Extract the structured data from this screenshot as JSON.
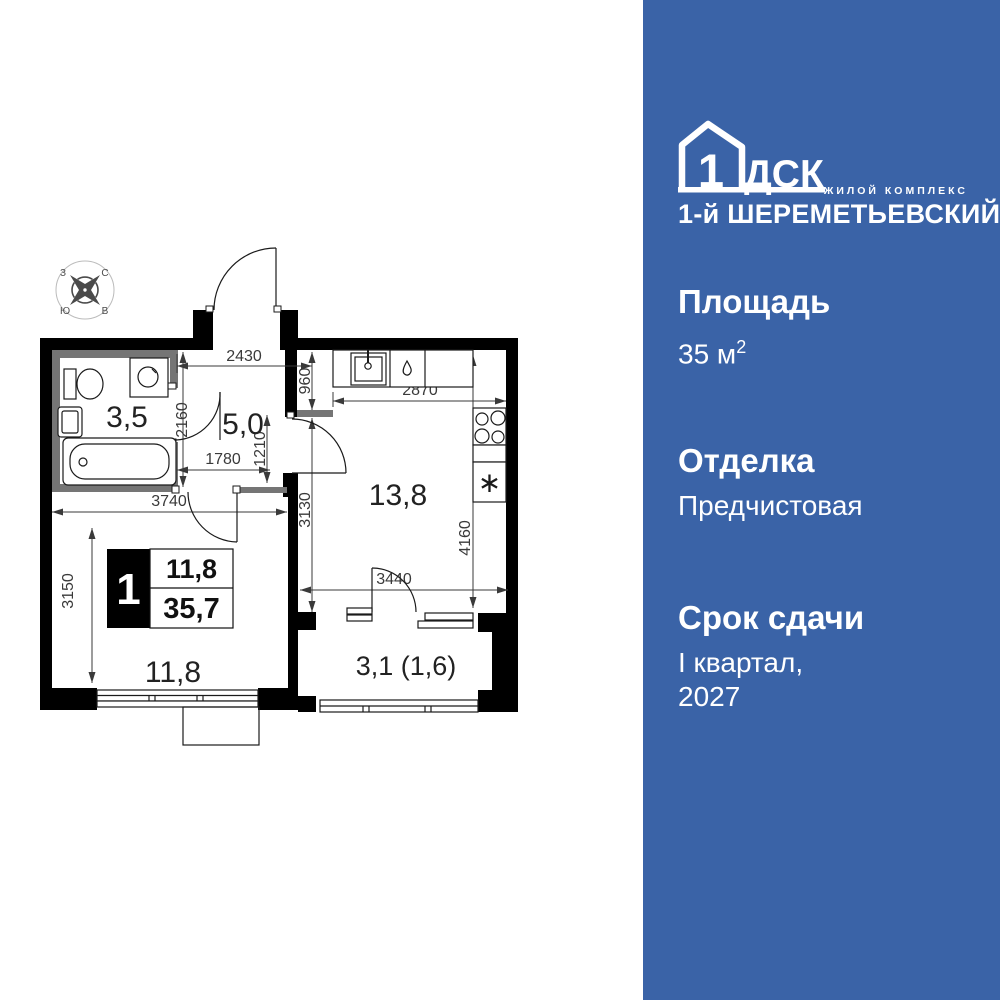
{
  "sidebar": {
    "bg": "#3a63a7",
    "logo": {
      "number": "1",
      "brand": "ДСК",
      "tagline": "ЖИЛОЙ КОМПЛЕКС",
      "name": "1-й ШЕРЕМЕТЬЕВСКИЙ"
    },
    "specs": {
      "area_label": "Площадь",
      "area_value": "35 м",
      "area_sup": "2",
      "finish_label": "Отделка",
      "finish_value": "Предчистовая",
      "deadline_label": "Срок сдачи",
      "deadline_line1": "I квартал,",
      "deadline_line2": "2027"
    }
  },
  "floorplan": {
    "compass": {
      "nw": "З",
      "ne": "С",
      "sw": "Ю",
      "se": "В"
    },
    "rooms": {
      "bathroom": "3,5",
      "hallway": "5,0",
      "kitchen": "13,8",
      "living": "11,8",
      "balcony": "3,1 (1,6)"
    },
    "badge": {
      "room_count": "1",
      "living_area": "11,8",
      "total_area": "35,7"
    },
    "dims": {
      "hall_width": "2430",
      "hall_top": "960",
      "hall_left": "2160",
      "hall_mid": "1210",
      "hall_bottom": "1780",
      "kitchen_width": "2870",
      "living_width": "3740",
      "living_height": "3150",
      "kitchen_inner_height": "3130",
      "kitchen_height": "4160",
      "kitchen_bottom_width": "3440"
    },
    "fridge_glyph": "∗"
  }
}
